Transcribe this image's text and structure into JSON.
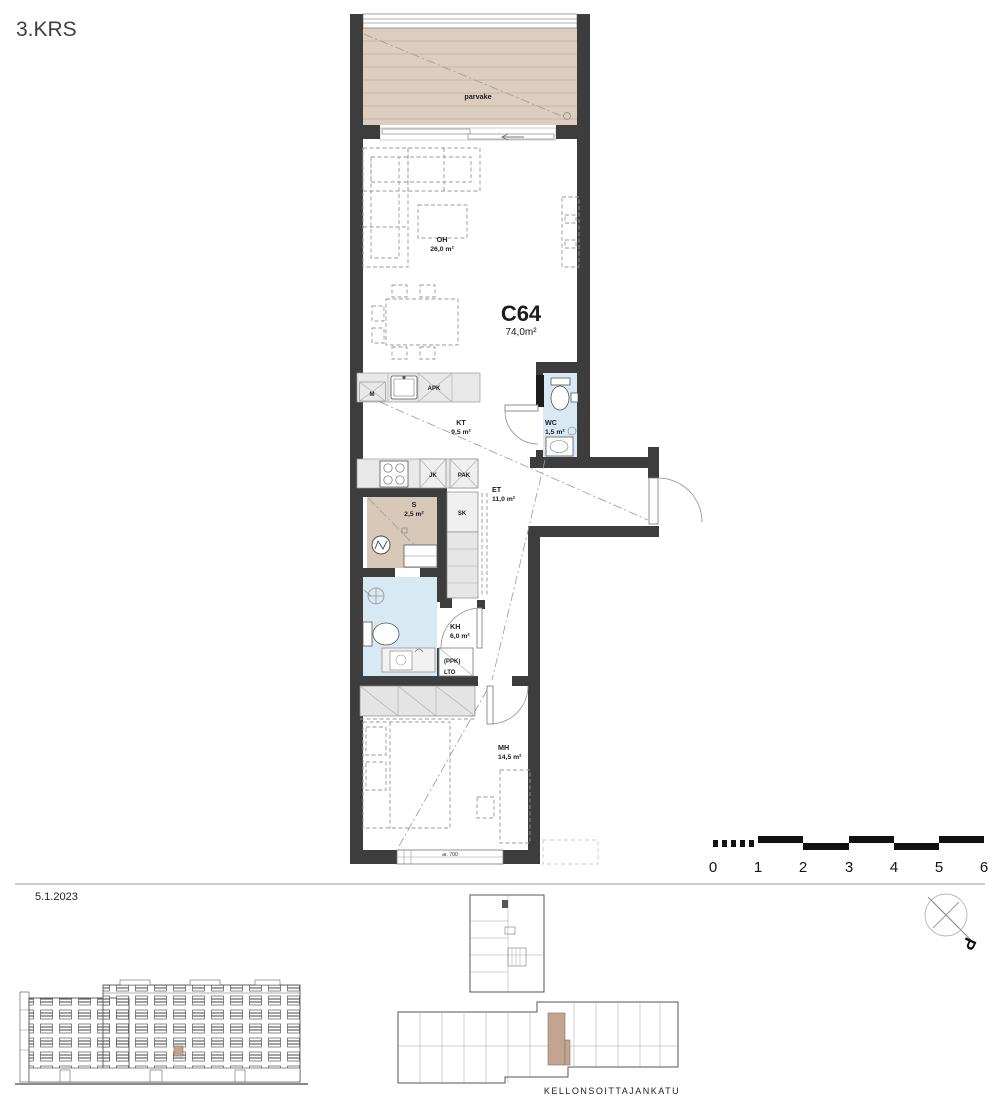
{
  "header": {
    "floor_label": "3.KRS",
    "date": "5.1.2023"
  },
  "apartment": {
    "id": "C64",
    "area": "74,0m²"
  },
  "rooms": {
    "balcony": {
      "label": "parvake"
    },
    "living": {
      "label": "OH",
      "area": "26,0 m²"
    },
    "kitchen": {
      "label": "KT",
      "area": "9,5 m²"
    },
    "wc": {
      "label": "WC",
      "area": "1,5 m²"
    },
    "hall": {
      "label": "ET",
      "area": "11,0 m²"
    },
    "sauna": {
      "label": "S",
      "area": "2,5 m²"
    },
    "bathroom": {
      "label": "KH",
      "area": "6,0 m²"
    },
    "bedroom": {
      "label": "MH",
      "area": "14,5 m²"
    }
  },
  "fixtures": {
    "microwave": "M",
    "dishwasher": "APK",
    "fridge": "JK",
    "freezer": "PAK",
    "closet": "SK",
    "washer": "(PPK)",
    "heat_recovery": "LTO",
    "window_sill_note": "ar. 700"
  },
  "scale_bar": {
    "ticks": [
      "0",
      "1",
      "2",
      "3",
      "4",
      "5",
      "6"
    ]
  },
  "site": {
    "street": "KELLONSOITTAJANKATU"
  },
  "north": {
    "label": "P"
  },
  "colors": {
    "wall": "#3d3d3d",
    "balcony_floor": "#dccdbe",
    "sauna_floor": "#d8c8b8",
    "wet_room": "#d8e9f3",
    "unit_highlight": "#c3a493"
  }
}
